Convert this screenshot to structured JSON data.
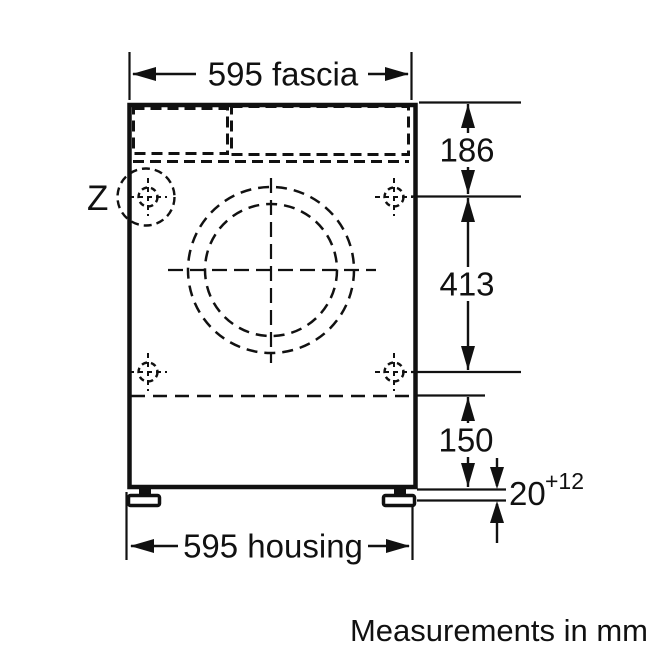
{
  "diagram": {
    "detail_marker": "Z",
    "note": "Measurements in mm",
    "labels": {
      "fascia": "595 fascia",
      "housing": "595 housing",
      "top_section": "186",
      "hole_span": "413",
      "bottom_section": "150",
      "plinth_nominal": "20",
      "plinth_tolerance": "+12"
    },
    "measurements_mm": {
      "fascia_width": 595,
      "housing_width": 595,
      "top_edge_to_upper_fixing_holes": 186,
      "upper_to_lower_fixing_holes": 413,
      "lower_holes_line_to_base": 150,
      "plinth_gap_nominal": 20,
      "plinth_gap_tolerance_plus": 12
    },
    "colors": {
      "ink": "#111111",
      "paper": "#ffffff"
    }
  }
}
